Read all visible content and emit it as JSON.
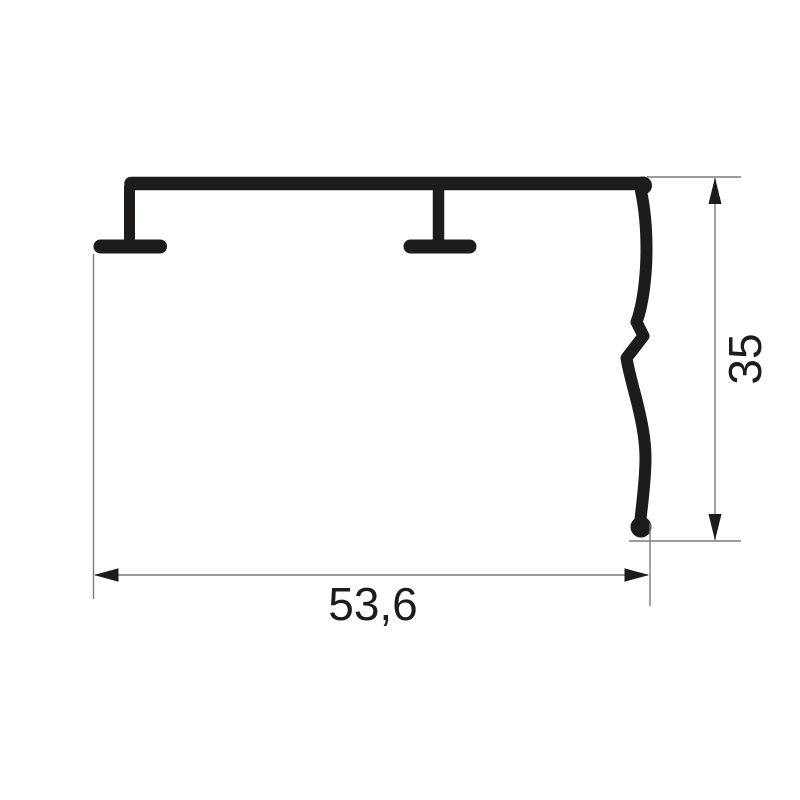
{
  "drawing": {
    "kind": "technical-dimension-drawing",
    "dimensions": {
      "width": {
        "label": "53,6"
      },
      "height": {
        "label": "35"
      }
    }
  },
  "colors": {
    "profile": "#1d1c1a",
    "dimension_line": "#7a7a7a",
    "arrow": "#1d1c1a",
    "text": "#1d1c1a",
    "background": "#ffffff"
  }
}
